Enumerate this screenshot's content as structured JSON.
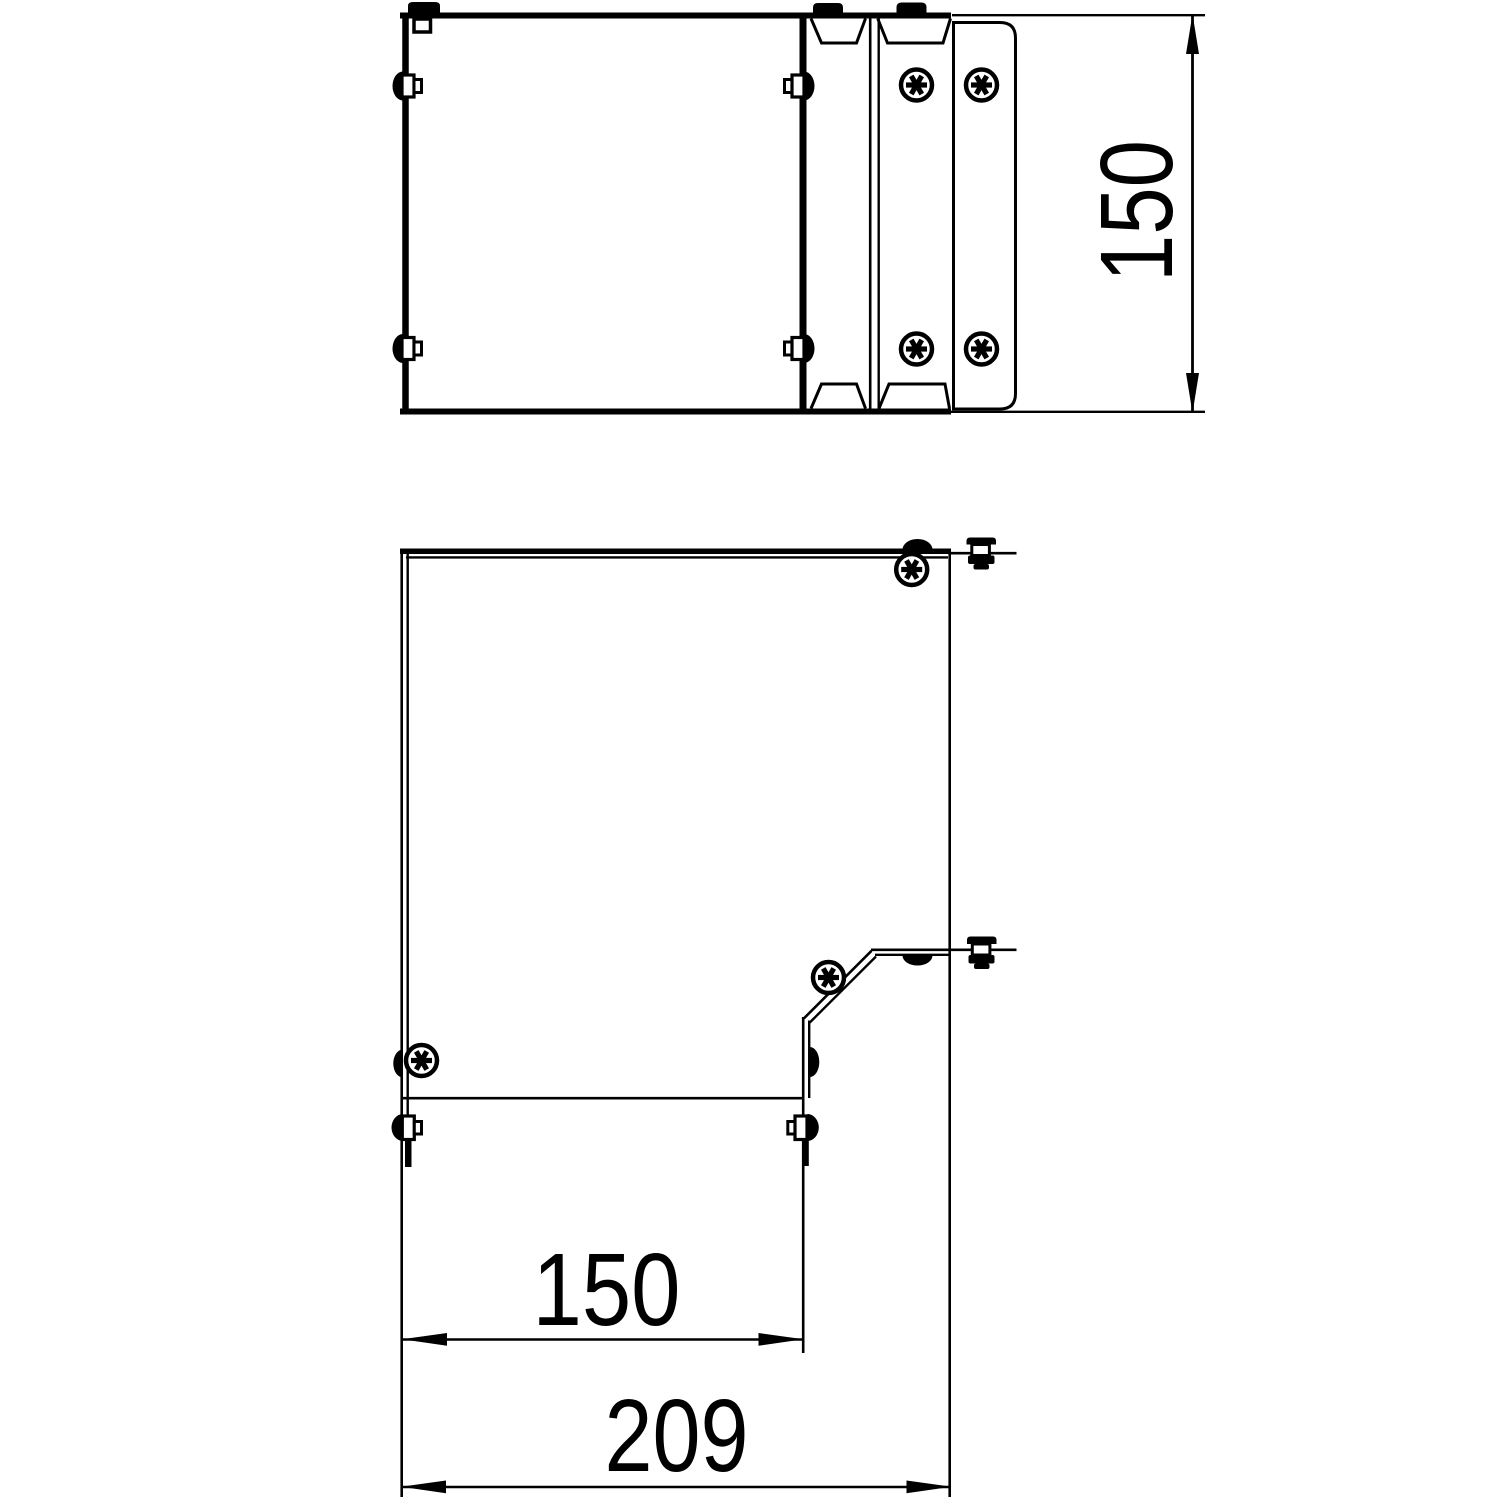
{
  "drawing": {
    "kind": "technical-orthographic-drawing",
    "colors": {
      "line": "#000000",
      "background": "#ffffff"
    },
    "views": {
      "side_view": {
        "name": "side-elevation-with-clamp-plate",
        "height_dimension": {
          "label": "150",
          "orientation": "vertical"
        }
      },
      "plan_view": {
        "name": "plan-view-of-bend-cover",
        "inner_width_dimension": {
          "label": "150",
          "orientation": "horizontal"
        },
        "overall_width_dimension": {
          "label": "209",
          "orientation": "horizontal"
        }
      }
    },
    "icons": {
      "torx-screw-icon": "circle with 6-point star",
      "turnbuckle-dome-icon": "solid half dome",
      "trunnion-bolt-icon": "stacked bolt side profile",
      "dimension-arrow-icon": "slender filled triangle"
    }
  }
}
